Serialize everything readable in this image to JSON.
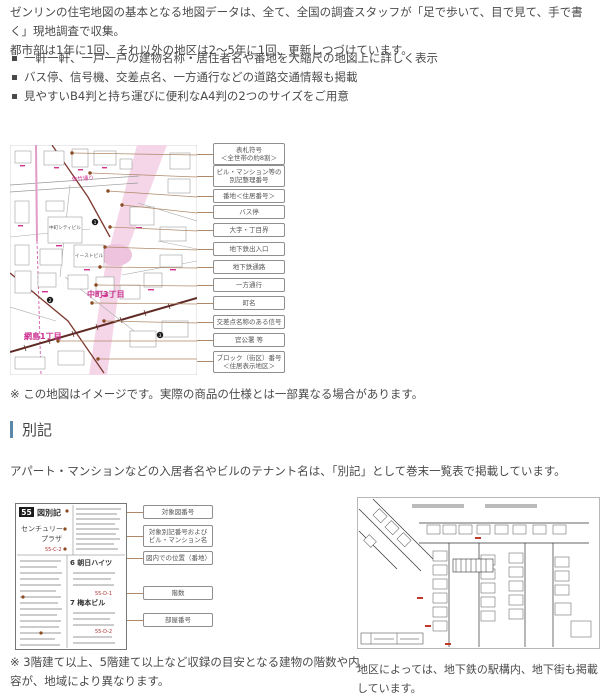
{
  "intro": {
    "line1": "ゼンリンの住宅地図の基本となる地図データは、全て、全国の調査スタッフが「足で歩いて、目で見て、手で書く」現地調査で収集。",
    "line2": "都市部は1年に1回、それ以外の地区は2〜5年に1回、更新しつづけています。"
  },
  "features": [
    "一軒一軒、一戸一戸の建物名称・居住者名や番地を大縮尺の地図上に詳しく表示",
    "バス停、信号機、交差点名、一方通行などの道路交通情報も掲載",
    "見やすいB4判と持ち運びに便利なA4判の2つのサイズをご用意"
  ],
  "map_figure": {
    "callouts": [
      "表札符号\n＜全世帯の約8割＞",
      "ビル・マンション等の\n別記整理番号",
      "番地＜住居番号＞",
      "バス停",
      "大字・丁目界",
      "地下鉄出入口",
      "地下鉄通路",
      "一方通行",
      "町名",
      "交差点名称のある信号",
      "官公署 等",
      "ブロック（街区）番号\n＜住居表示地区＞"
    ],
    "labels": {
      "town_a": "中町3丁目",
      "town_b": "網島1丁目",
      "street": "佐竹通り",
      "building_a": "中町シティビル",
      "building_b": "イーストビル",
      "num1": "1",
      "num2": "2",
      "num3": "3"
    }
  },
  "map_note": "※ この地図はイメージです。実際の商品の仕様とは一部異なる場合があります。",
  "bekki": {
    "title": "別記",
    "description": "アパート・マンションなどの入居者名やビルのテナント名は、「別記」として巻末一覧表で掲載しています。",
    "legend": {
      "page_no": "55",
      "label": "図別記",
      "building_line1": "センチュリー",
      "building_line2": "プラザ",
      "code_a": "55-C-2",
      "entry_a": "6 朝日ハイツ",
      "code_b": "55-D-1",
      "entry_b": "7 梅本ビル",
      "code_c": "55-D-2",
      "callouts": [
        "対象図番号",
        "対象別記番号および\nビル・マンション名",
        "図内での位置（番地）",
        "階数",
        "部屋番号"
      ]
    },
    "floors_note": "※ 3階建て以上、5階建て以上など収録の目安となる建物の階数や内容が、地域により異なります。",
    "underground_note": "地区によっては、地下鉄の駅構内、地下街も掲載しています。"
  },
  "colors": {
    "accent_magenta": "#cc2f8f",
    "pink_fill": "#f4d6e8",
    "road_maroon": "#7d3a30",
    "rail_dark": "#5f2a24",
    "leader_brown": "#b08968",
    "text_gray": "#4a4a4a",
    "header_bar_blue": "#5b87a8"
  }
}
